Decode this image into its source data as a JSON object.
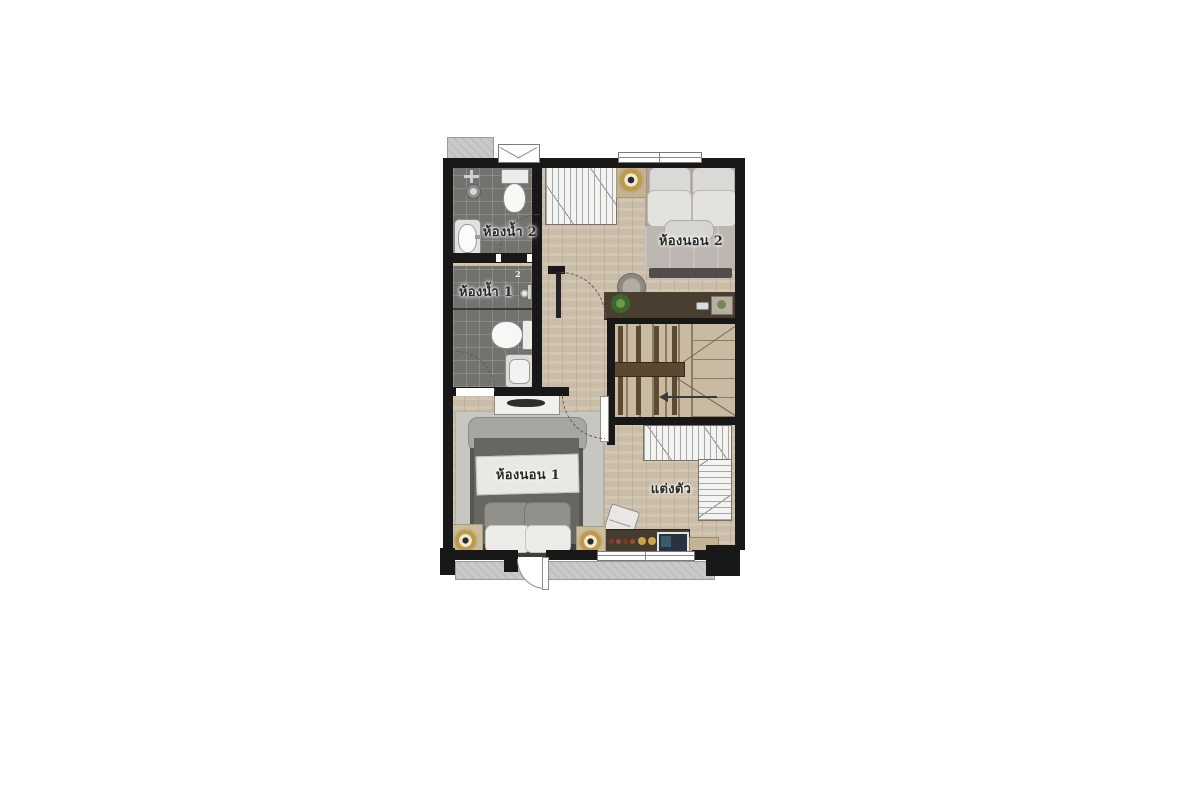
{
  "floorplan": {
    "type": "residential-floor-plan",
    "floor": "upper-floor",
    "rooms": [
      {
        "id": "bathroom-2",
        "label": "ห้องน้ำ 2"
      },
      {
        "id": "bathroom-1",
        "label": "ห้องน้ำ 1"
      },
      {
        "id": "bedroom-2",
        "label": "ห้องนอน 2"
      },
      {
        "id": "bedroom-1",
        "label": "ห้องนอน 1"
      },
      {
        "id": "dressing-area",
        "label": "แต่งตัว"
      }
    ],
    "markers": {
      "shower_valve_number": "2"
    },
    "stairs": {
      "direction_arrow": "left"
    },
    "colors": {
      "wall": "#181818",
      "wood_floor": "#cfc2ae",
      "bathroom_tile": "#74726f",
      "concrete_ledge": "#c9c9c7",
      "wardrobe_hatch": "#f3f3f1",
      "desk_wood": "#4a3e31",
      "brass_lamp": "#bd9a4e",
      "bed1_duvet": "#66655f",
      "bed2_duvet": "#bcb5b0"
    },
    "furniture": [
      "bed",
      "wardrobe",
      "desk",
      "stool",
      "toilet",
      "sink",
      "shower",
      "bathtub-none",
      "stairs",
      "tv-console",
      "nightstand-lamps",
      "dresser",
      "chair",
      "plant",
      "balcony"
    ]
  }
}
